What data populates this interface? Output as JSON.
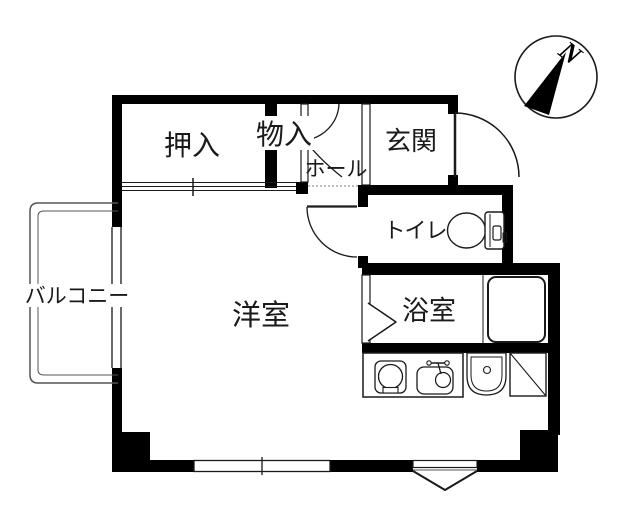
{
  "floorplan": {
    "rooms": {
      "oshiire": {
        "label": "押入"
      },
      "monoire": {
        "label": "物入"
      },
      "hall": {
        "label": "ホール"
      },
      "genkan": {
        "label": "玄関"
      },
      "toilet": {
        "label": "トイレ"
      },
      "western_room": {
        "label": "洋室"
      },
      "bathroom": {
        "label": "浴室"
      },
      "balcony": {
        "label": "バルコニー"
      }
    },
    "compass": {
      "north_label": "N"
    },
    "colors": {
      "wall": "#000000",
      "line": "#1a1a1a",
      "thin_line": "#555555",
      "background": "#ffffff"
    }
  }
}
